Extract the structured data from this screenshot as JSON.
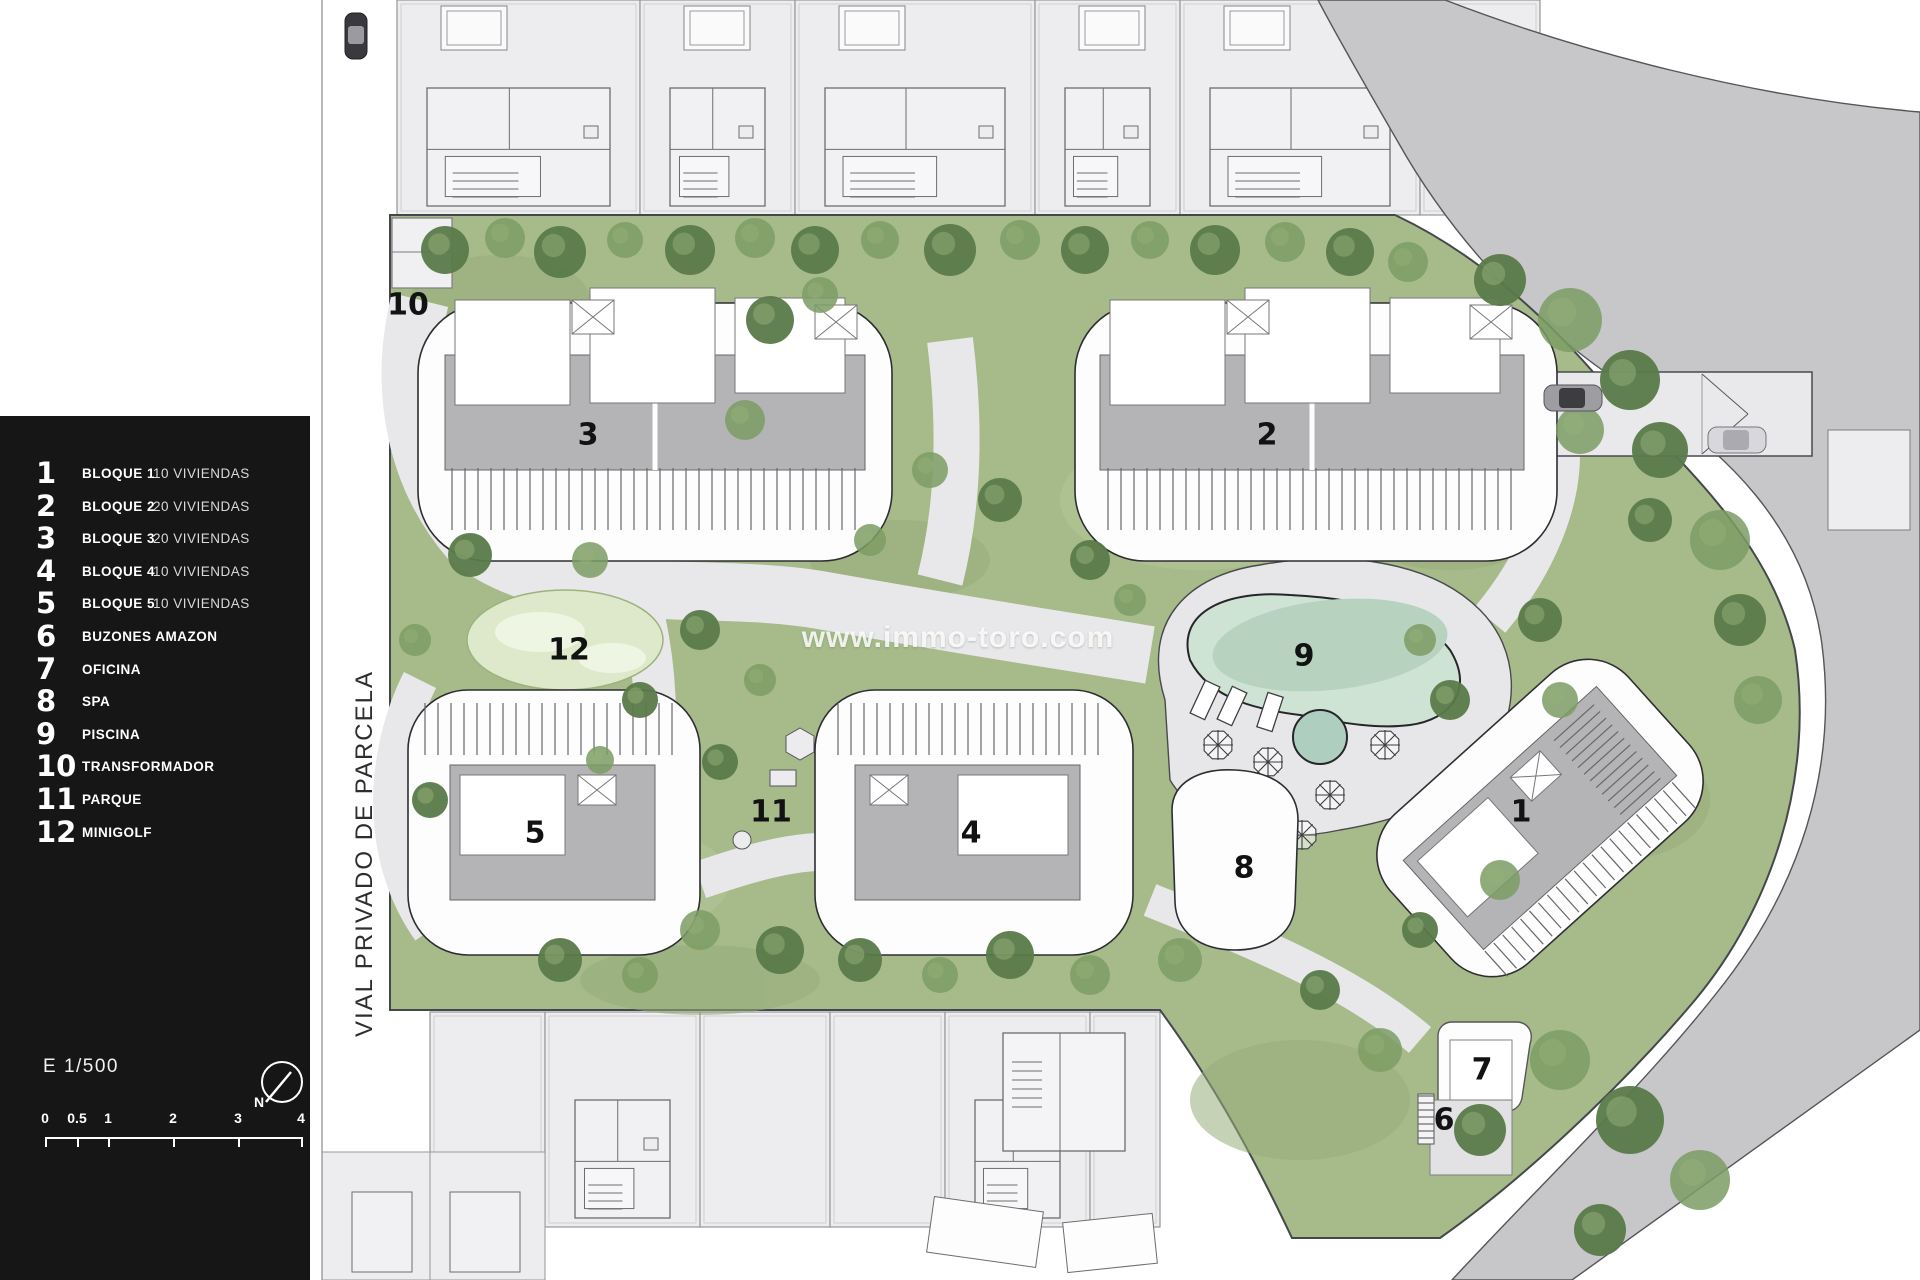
{
  "colors": {
    "panel_bg": "#161616",
    "lawn_green": "#a6ba8a",
    "tree_dark": "#5a7a4a",
    "tree_mid": "#7d9c64",
    "path_gray": "#e8e8ea",
    "road_gray": "#c7c7c9",
    "roof_gray": "#b4b4b6",
    "pool_water": "#b7d2bf",
    "pool_water_light": "#cfe3d4",
    "neighbor_plot": "#ededef"
  },
  "legend": {
    "items": [
      {
        "num": "1",
        "label": "BLOQUE 1",
        "detail": "10 VIVIENDAS"
      },
      {
        "num": "2",
        "label": "BLOQUE 2",
        "detail": "20 VIVIENDAS"
      },
      {
        "num": "3",
        "label": "BLOQUE 3",
        "detail": "20 VIVIENDAS"
      },
      {
        "num": "4",
        "label": "BLOQUE 4",
        "detail": "10 VIVIENDAS"
      },
      {
        "num": "5",
        "label": "BLOQUE 5",
        "detail": "10 VIVIENDAS"
      },
      {
        "num": "6",
        "label": "BUZONES AMAZON",
        "detail": ""
      },
      {
        "num": "7",
        "label": "OFICINA",
        "detail": ""
      },
      {
        "num": "8",
        "label": "SPA",
        "detail": ""
      },
      {
        "num": "9",
        "label": "PISCINA",
        "detail": ""
      },
      {
        "num": "10",
        "label": "TRANSFORMADOR",
        "detail": ""
      },
      {
        "num": "11",
        "label": "PARQUE",
        "detail": ""
      },
      {
        "num": "12",
        "label": "MINIGOLF",
        "detail": ""
      }
    ],
    "scale_text": "E 1/500",
    "north_label": "N",
    "scale_ticks": [
      "0",
      "0.5",
      "1",
      "2",
      "3",
      "4"
    ]
  },
  "street_label": "VIAL PRIVADO DE PARCELA",
  "watermark": "www.immo-toro.com",
  "map": {
    "labels": [
      {
        "id": "transformador",
        "text": "10"
      },
      {
        "id": "bloque-3",
        "text": "3"
      },
      {
        "id": "bloque-2",
        "text": "2"
      },
      {
        "id": "minigolf",
        "text": "12"
      },
      {
        "id": "piscina",
        "text": "9"
      },
      {
        "id": "bloque-5",
        "text": "5"
      },
      {
        "id": "parque",
        "text": "11"
      },
      {
        "id": "bloque-4",
        "text": "4"
      },
      {
        "id": "bloque-1",
        "text": "1"
      },
      {
        "id": "spa",
        "text": "8"
      },
      {
        "id": "oficina",
        "text": "7"
      },
      {
        "id": "buzones",
        "text": "6"
      }
    ]
  }
}
